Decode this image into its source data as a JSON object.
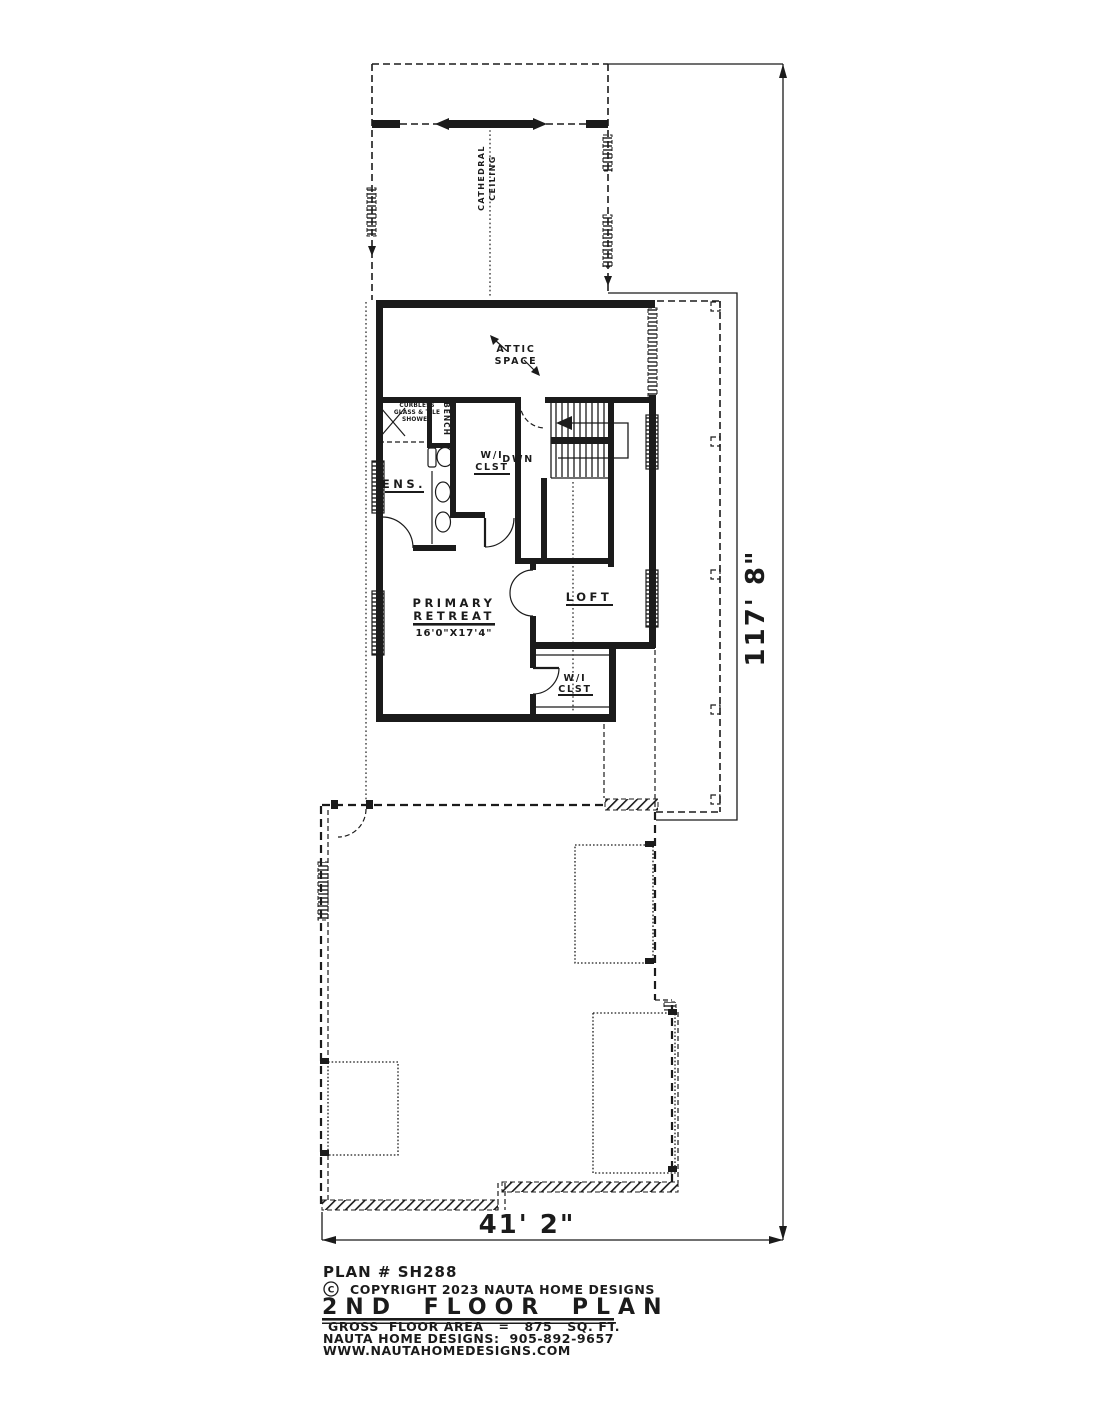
{
  "plan": {
    "ceiling_note": {
      "line1": "CATHEDRAL",
      "line2": "CEILING"
    },
    "rooms": {
      "attic": {
        "line1": "ATTIC",
        "line2": "SPACE"
      },
      "shower": {
        "line1": "CURBLESS",
        "line2": "GLASS & TILE",
        "line3": "SHOWER"
      },
      "bench": {
        "label": "BENCH"
      },
      "ensuite": {
        "label": "ENS."
      },
      "closet_upper": {
        "line1": "W/I",
        "line2": "CLST"
      },
      "stairs": {
        "label": "DWN"
      },
      "loft": {
        "label": "LOFT"
      },
      "primary": {
        "line1": "PRIMARY",
        "line2": "RETREAT",
        "size": "16'0\"X17'4\""
      },
      "closet_lower": {
        "line1": "W/I",
        "line2": "CLST"
      }
    },
    "dimensions": {
      "overall_depth": "117' 8\"",
      "overall_width": "41' 2\""
    },
    "title_block": {
      "plan_number": "PLAN # SH288",
      "copyright_symbol": "C",
      "copyright": "COPYRIGHT 2023 NAUTA HOME DESIGNS",
      "sheet_title": "2ND FLOOR PLAN",
      "floor_area": "GROSS  FLOOR AREA   =   875   SQ. FT.",
      "phone": "NAUTA HOME DESIGNS:  905-892-9657",
      "website": "WWW.NAUTAHOMEDESIGNS.COM"
    },
    "colors": {
      "ink": "#1b1b1b",
      "paper": "#ffffff"
    }
  }
}
